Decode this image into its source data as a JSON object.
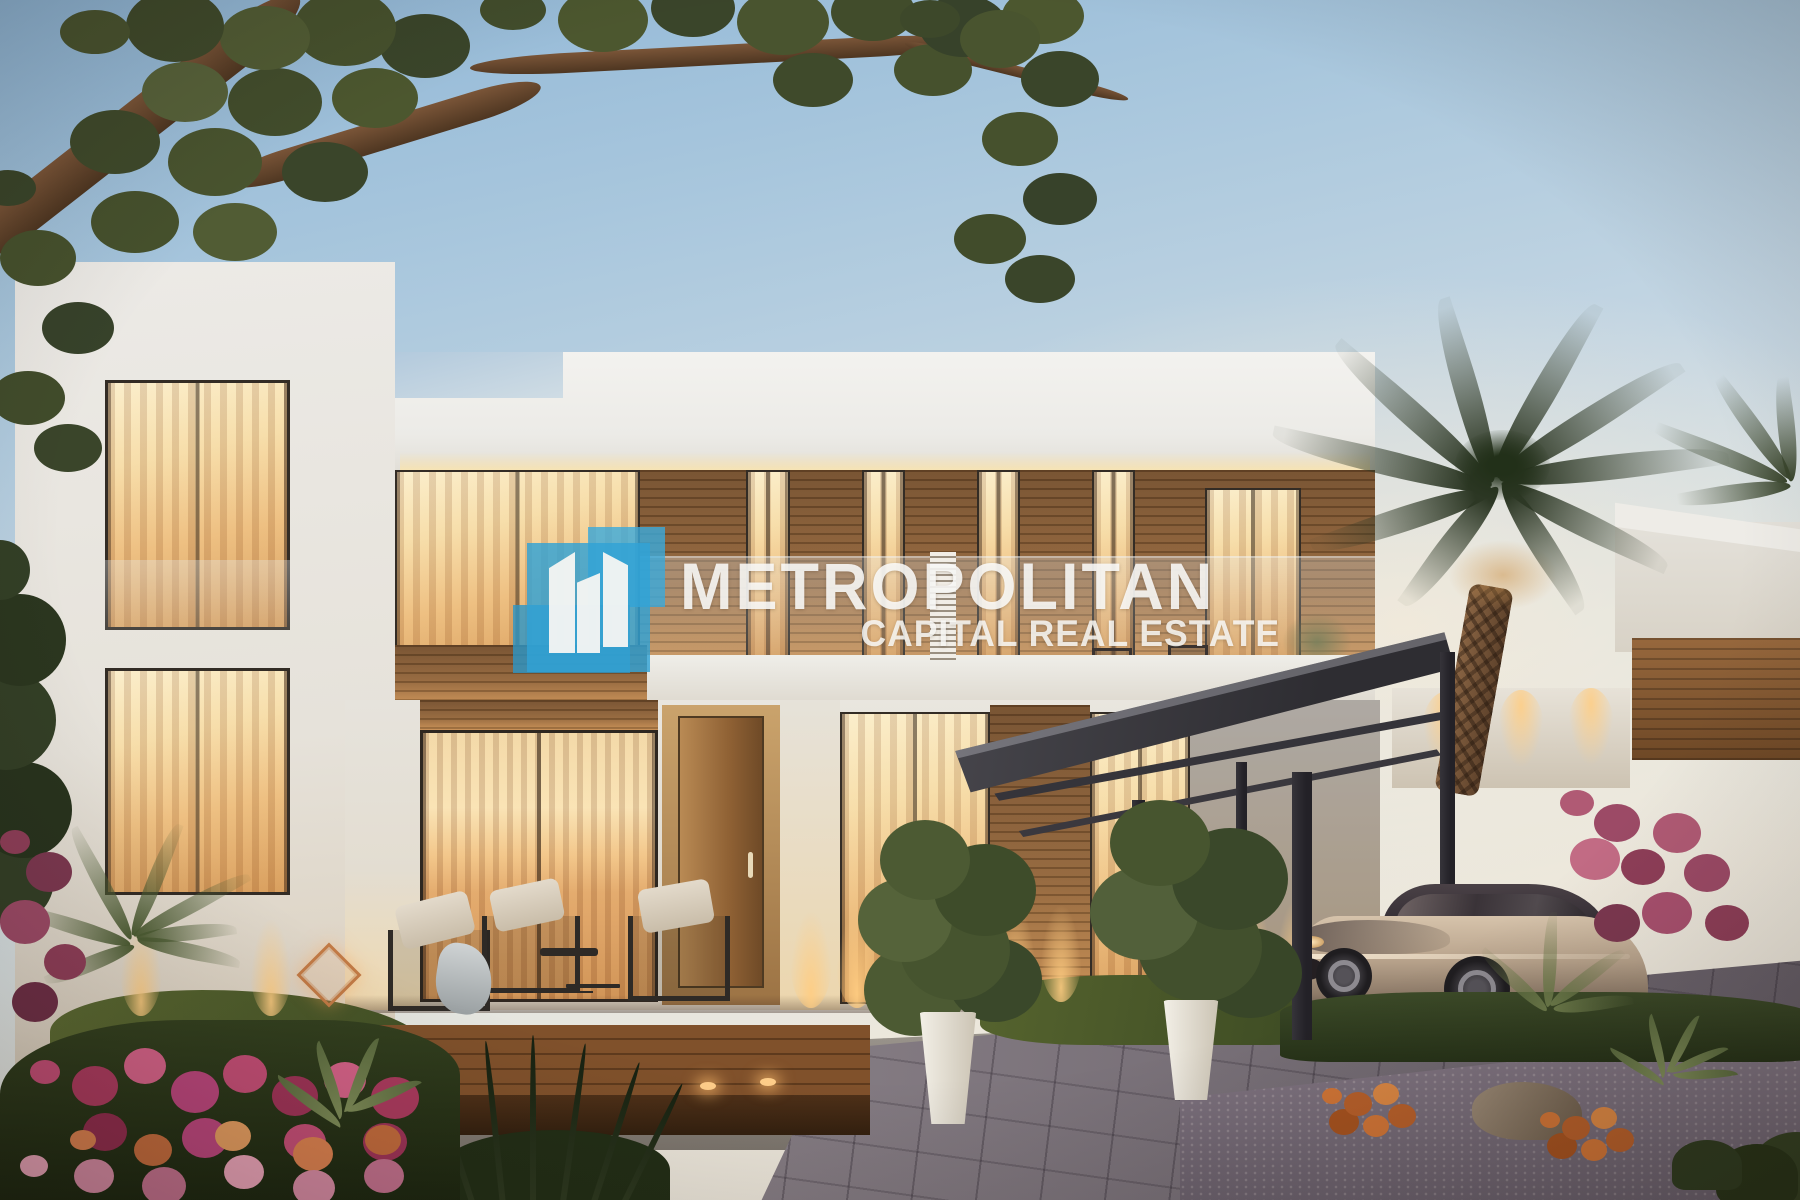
{
  "watermark": {
    "title": "METROPOLITAN",
    "subtitle": "CAPITAL REAL ESTATE",
    "logo_icon": "skyscrapers-logo-icon",
    "brand_blue": "#31a2d6",
    "brand_white": "#faf8f4",
    "text_color": "rgba(252,252,250,0.88)"
  },
  "scene": {
    "palette": {
      "sky_blue": "#8fb6d6",
      "sky_warm": "#f6e7cf",
      "villa_white": "#ecebe7",
      "wood_brown": "#8a5a33",
      "window_glow": "#f7dda8",
      "carport_grey": "#3f3e44",
      "palm_green": "#2c3724",
      "lawn_green": "#55632e",
      "driveway_grey": "#8b8289",
      "flower_pink": "#c14d74",
      "car_champagne": "#b7a28b"
    }
  }
}
